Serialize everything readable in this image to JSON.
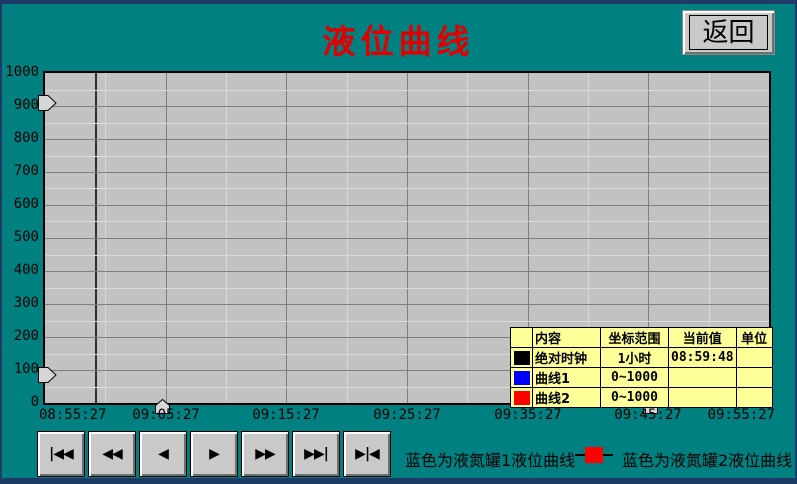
{
  "window": {
    "title": "液位曲线",
    "back_button": "返回"
  },
  "chart_data": {
    "type": "line",
    "title": "液位曲线",
    "y_axis": {
      "min": 0,
      "max": 1000,
      "major_step": 100,
      "minor_step": 50,
      "tick_labels": [
        "1000",
        "900",
        "800",
        "700",
        "600",
        "500",
        "400",
        "300",
        "200",
        "100",
        "0"
      ]
    },
    "x_axis": {
      "span": "1小时",
      "minor_divisions": 12,
      "tick_labels": [
        "08:55:27",
        "09:05:27",
        "09:15:27",
        "09:25:27",
        "09:35:27",
        "09:45:27",
        "09:55:27"
      ]
    },
    "grid": "on",
    "cursor_time": "08:59:48",
    "series": [
      {
        "name": "曲线1",
        "color": "#0000ff",
        "range": "0~1000",
        "values": []
      },
      {
        "name": "曲线2",
        "color": "#ff0000",
        "range": "0~1000",
        "values": []
      }
    ]
  },
  "legend_table": {
    "headers": [
      "",
      "内容",
      "坐标范围",
      "当前值",
      "单位"
    ],
    "rows": [
      {
        "swatch": "#000000",
        "content": "绝对时钟",
        "range": "1小时",
        "current": "08:59:48",
        "unit": ""
      },
      {
        "swatch": "#0000ff",
        "content": "曲线1",
        "range": "0~1000",
        "current": "",
        "unit": ""
      },
      {
        "swatch": "#ff0000",
        "content": "曲线2",
        "range": "0~1000",
        "current": "",
        "unit": ""
      }
    ]
  },
  "playback": {
    "buttons": [
      {
        "name": "skip-to-start",
        "glyph": "|◀◀"
      },
      {
        "name": "fast-rewind",
        "glyph": "◀◀"
      },
      {
        "name": "step-back",
        "glyph": "◀"
      },
      {
        "name": "step-forward",
        "glyph": "▶"
      },
      {
        "name": "fast-forward",
        "glyph": "▶▶"
      },
      {
        "name": "skip-to-end",
        "glyph": "▶▶|"
      },
      {
        "name": "jump-to-latest",
        "glyph": "▶|◀"
      }
    ]
  },
  "footer": {
    "caption1": "蓝色为液氮罐1液位曲线",
    "caption2": "蓝色为液氮罐2液位曲线"
  },
  "colors": {
    "background_teal": "#008080",
    "frame_navy": "#1e3a66",
    "chart_background": "#c2c2c2",
    "grid_major": "#7f7f7f",
    "grid_minor": "#d9d9d9",
    "cursor": "#2e2e2e",
    "title_red": "#e00000",
    "legend_background": "#ffff99",
    "curve1_blue": "#0000ff",
    "curve2_red": "#ff0000",
    "button_face": "#c9c9c9"
  }
}
